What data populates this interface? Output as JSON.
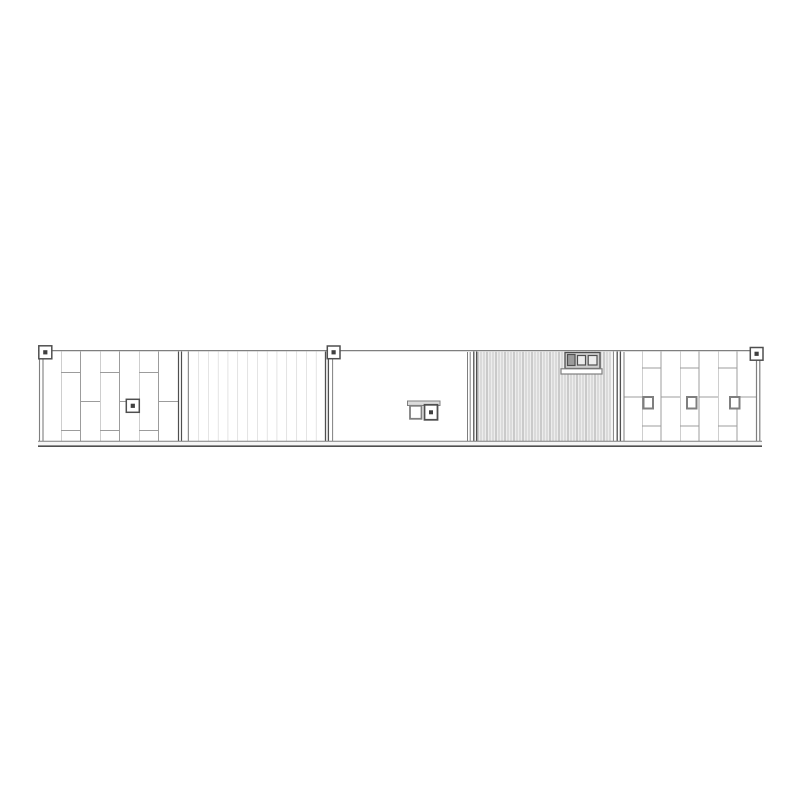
{
  "canvas": {
    "width": 800,
    "height": 800
  },
  "drawing": {
    "type": "architectural-elevation",
    "title": "Side elevation of five wall modules",
    "modules": [
      {
        "id": "module-1",
        "cladding": "staggered-vertical-planks",
        "fixtures": [
          "corner-marker-top-left",
          "square-dot-marker"
        ]
      },
      {
        "id": "module-2",
        "cladding": "vertical-siding"
      },
      {
        "id": "module-3",
        "cladding": "plain",
        "fixtures": [
          "corner-marker-top-left",
          "double-outlet-box"
        ]
      },
      {
        "id": "module-4",
        "cladding": "corrugated",
        "fixtures": [
          "vent-unit-with-two-windows"
        ]
      },
      {
        "id": "module-5",
        "cladding": "staggered-vertical-planks",
        "fixtures": [
          "corner-marker-top-right",
          "wall-fixture-1",
          "wall-fixture-2",
          "wall-fixture-3"
        ]
      }
    ],
    "marker_count_top": 3,
    "wall_fixture_count_module_5": 3
  },
  "colors": {
    "background": "#ffffff",
    "panel_fill": "#ffffff",
    "edge": "#4f4f4f",
    "line": "#7f7f7f",
    "plank_line": "#9c9c9c",
    "siding_line": "#c9c9c9",
    "corrugation_bg": "#ededed",
    "corrugation_dark": "#a6a6a6",
    "corrugation_light": "#c6c6c6",
    "marker_dot": "#3f3f3f",
    "box_gray": "#cfcfcf",
    "box_dark": "#9b9b9b",
    "window_light": "#ededed",
    "bar_gray": "#dcdcdc",
    "band_fill": "#f6f6f6"
  }
}
